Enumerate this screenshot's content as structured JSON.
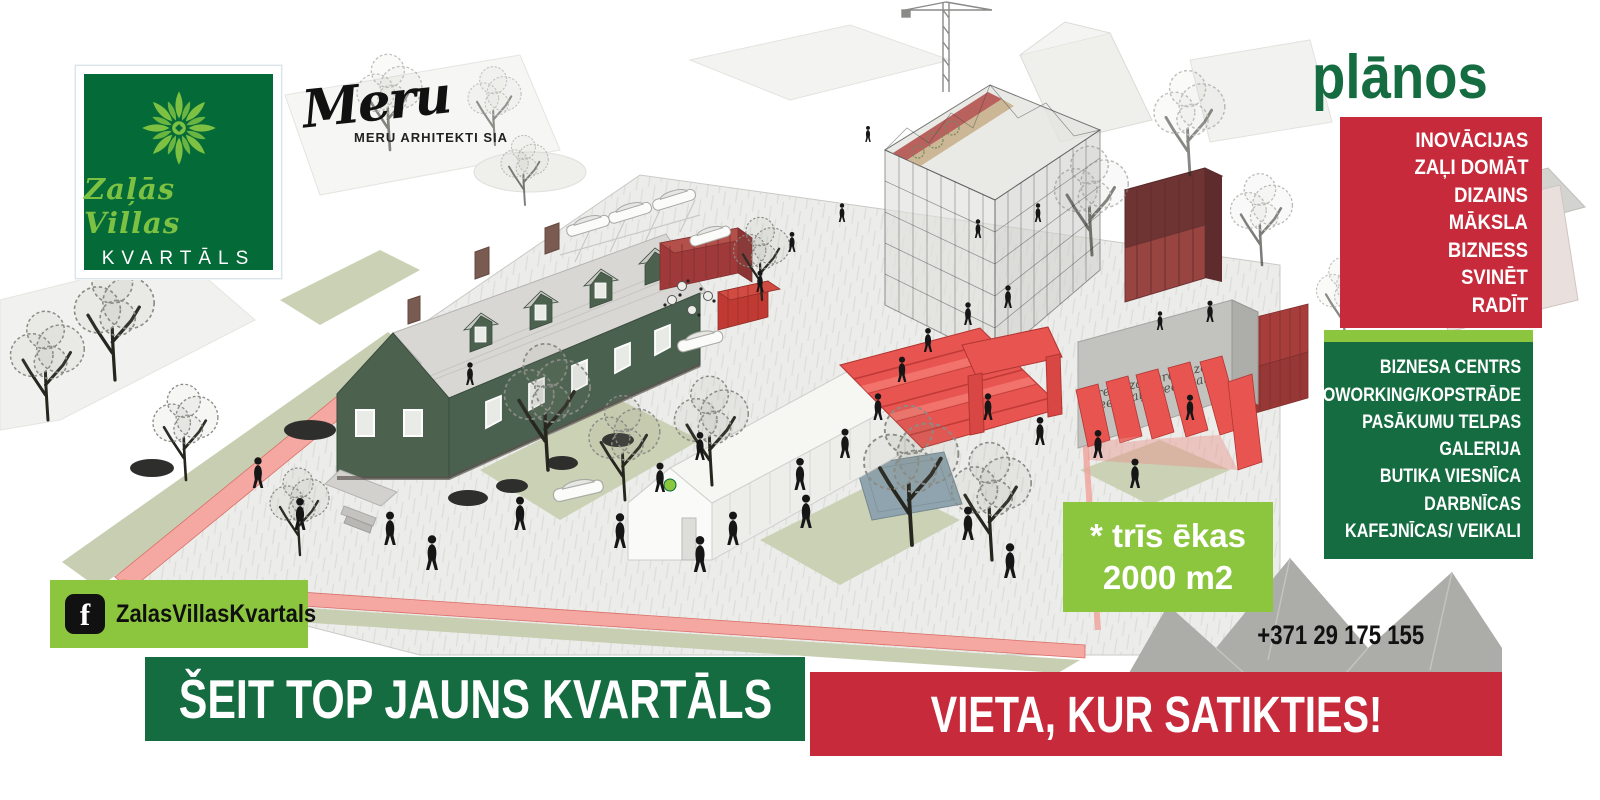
{
  "brand": {
    "name_script": "Zaļās Villas",
    "name_caps": "KVARTĀLS",
    "architect_script": "Meru",
    "architect_caps": "MERU ARHITEKTI SIA"
  },
  "plans": {
    "heading": "plānos",
    "values": [
      "INOVĀCIJAS",
      "ZAĻI DOMĀT",
      "DIZAINS",
      "MĀKSLA",
      "BIZNESS",
      "SVINĒT",
      "RADĪT"
    ],
    "amenities": [
      "BIZNESA CENTRS",
      "COWORKING/KOPSTRĀDE",
      "PASĀKUMU TELPAS",
      "GALERIJA",
      "BUTIKA VIESNĪCA",
      "DARBNĪCAS",
      "KAFEJNĪCAS/ VEIKALI"
    ]
  },
  "callout": {
    "line1": "* trīs ēkas",
    "line2": "2000 m2"
  },
  "contact": {
    "phone": "+371 29 175 155",
    "facebook_handle": "ZalasVillasKvartals",
    "facebook_icon_letter": "f"
  },
  "banners": {
    "green": "ŠEIT TOP JAUNS KVARTĀLS",
    "red": "VIETA, KUR SATIKTIES!"
  },
  "scene": {
    "wall_text_line1": "green zaļi green zaļi",
    "wall_text_line2": "green zaļi green zaļi"
  },
  "colors": {
    "dark_green": "#156C40",
    "logo_green": "#046A38",
    "lime": "#8CC63F",
    "red": "#C62A3B",
    "villa_green": "#4A614F",
    "coral_red": "#E85450"
  }
}
